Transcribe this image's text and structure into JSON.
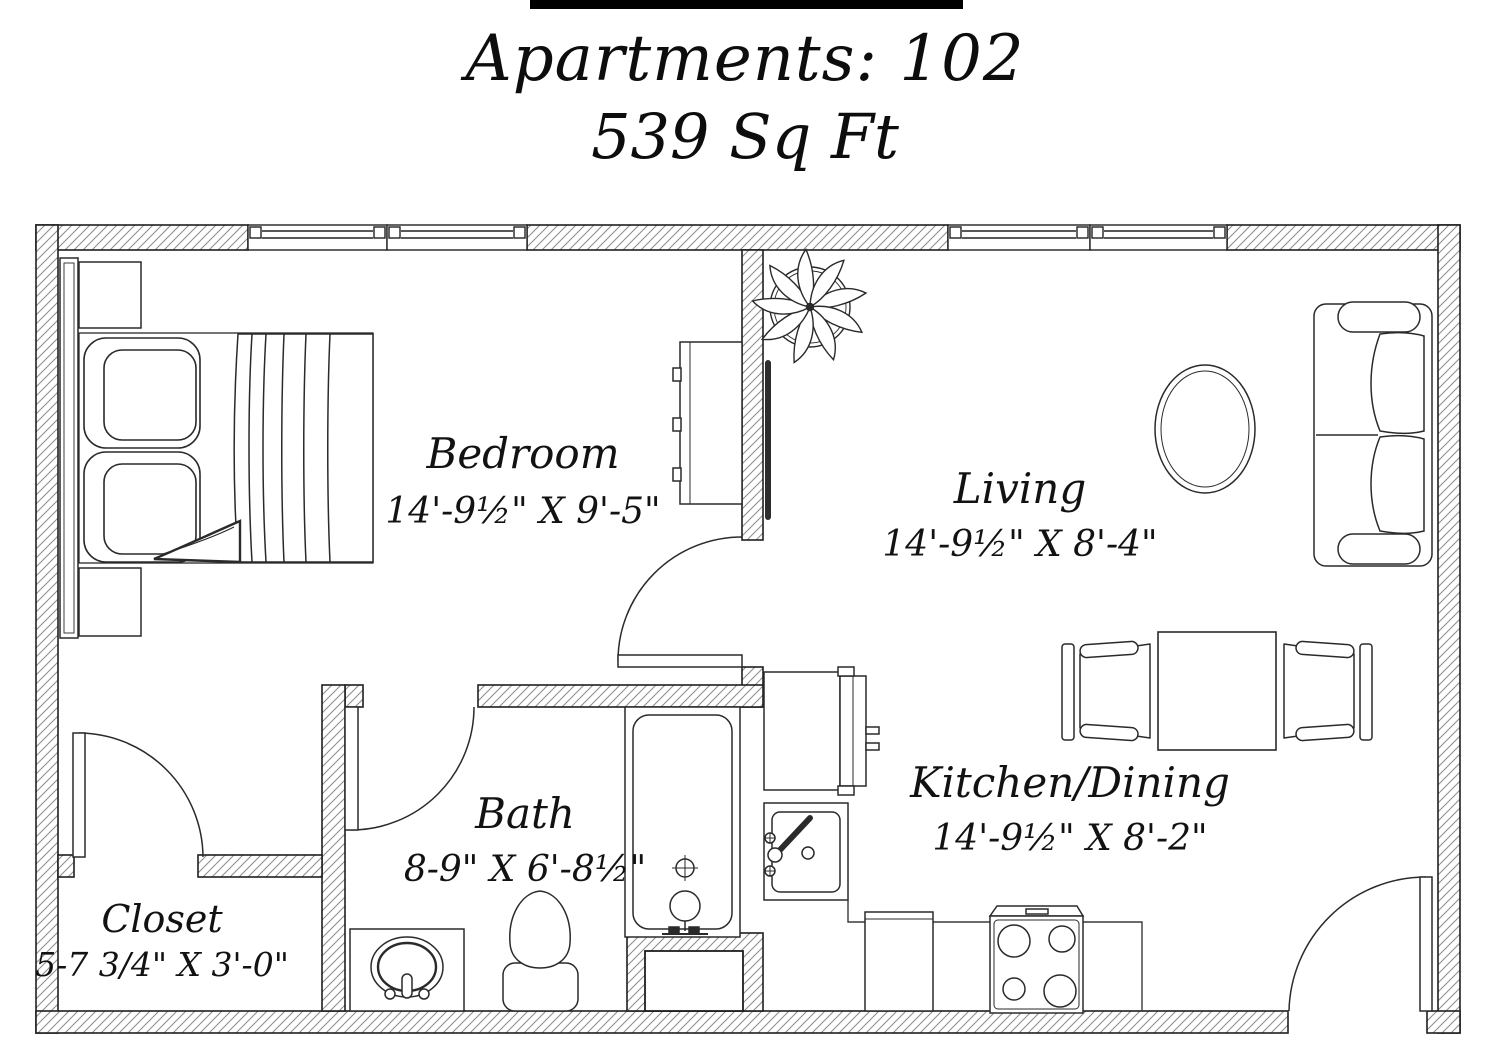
{
  "title": {
    "line1": "Apartments: 102",
    "line2": "539 Sq Ft"
  },
  "rooms": {
    "bedroom": {
      "name": "Bedroom",
      "dimensions": "14'-9½\" X 9'-5\""
    },
    "living": {
      "name": "Living",
      "dimensions": "14'-9½\" X 8'-4\""
    },
    "kitchen_dining": {
      "name": "Kitchen/Dining",
      "dimensions": "14'-9½\" X 8'-2\""
    },
    "bath": {
      "name": "Bath",
      "dimensions": "8-9\" X 6'-8½\""
    },
    "closet": {
      "name": "Closet",
      "dimensions": "5-7 3/4\" X 3'-0\""
    }
  },
  "fixtures": [
    "bed",
    "pillows",
    "blanket",
    "headboard",
    "nightstand-top",
    "nightstand-bottom",
    "dresser",
    "wall-tv",
    "potted-plant",
    "sofa",
    "oval-coffee-table",
    "dining-table",
    "dining-chair-left",
    "dining-chair-right",
    "refrigerator",
    "kitchen-sink",
    "counter",
    "dishwasher",
    "stove",
    "bathtub",
    "toilet",
    "vanity-sink",
    "wall-niche",
    "bedroom-door",
    "bath-door",
    "closet-door",
    "entry-door",
    "bedroom-window-left",
    "bedroom-window-right",
    "living-window-left",
    "living-window-right"
  ],
  "colors": {
    "line": "#1f1f1f",
    "hatch": "#8f8f8f",
    "background": "#ffffff",
    "top_bar": "#000000"
  }
}
